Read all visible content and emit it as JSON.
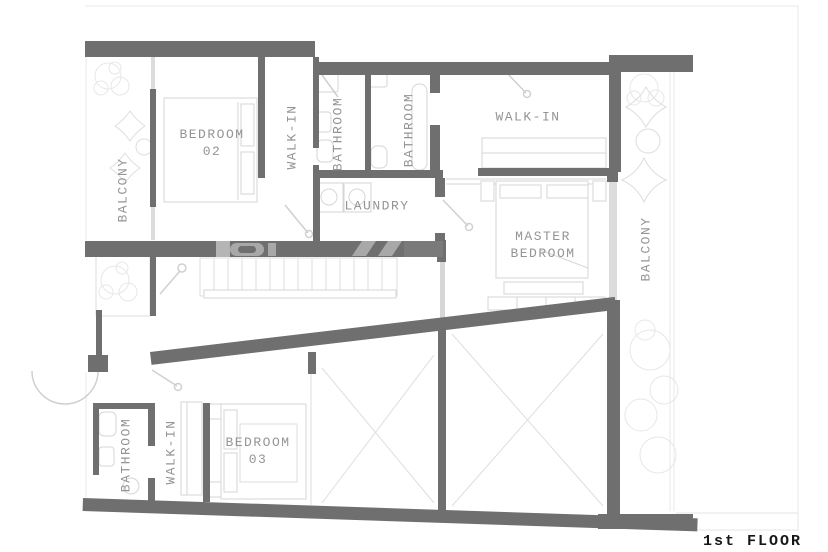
{
  "title": {
    "floor_label": "1st FLOOR"
  },
  "rooms": {
    "balcony_left": {
      "label": "BALCONY"
    },
    "bedroom_02": {
      "line1": "BEDROOM",
      "line2": "02"
    },
    "walk_in_top": {
      "label": "WALK-IN"
    },
    "bathroom_top_1": {
      "label": "BATHROOM"
    },
    "bathroom_top_2": {
      "label": "BATHROOM"
    },
    "walk_in_master": {
      "label": "WALK-IN"
    },
    "laundry": {
      "label": "LAUNDRY"
    },
    "master_bedroom": {
      "line1": "MASTER",
      "line2": "BEDROOM"
    },
    "balcony_right": {
      "label": "BALCONY"
    },
    "bathroom_lower": {
      "label": "BATHROOM"
    },
    "walk_in_lower": {
      "label": "WALK-IN"
    },
    "bedroom_03": {
      "line1": "BEDROOM",
      "line2": "03"
    }
  },
  "colors": {
    "wall": "#6f6f6f",
    "furniture_line": "#d6d6d6",
    "label_text": "#949494",
    "title_text": "#161616",
    "background": "#ffffff"
  }
}
